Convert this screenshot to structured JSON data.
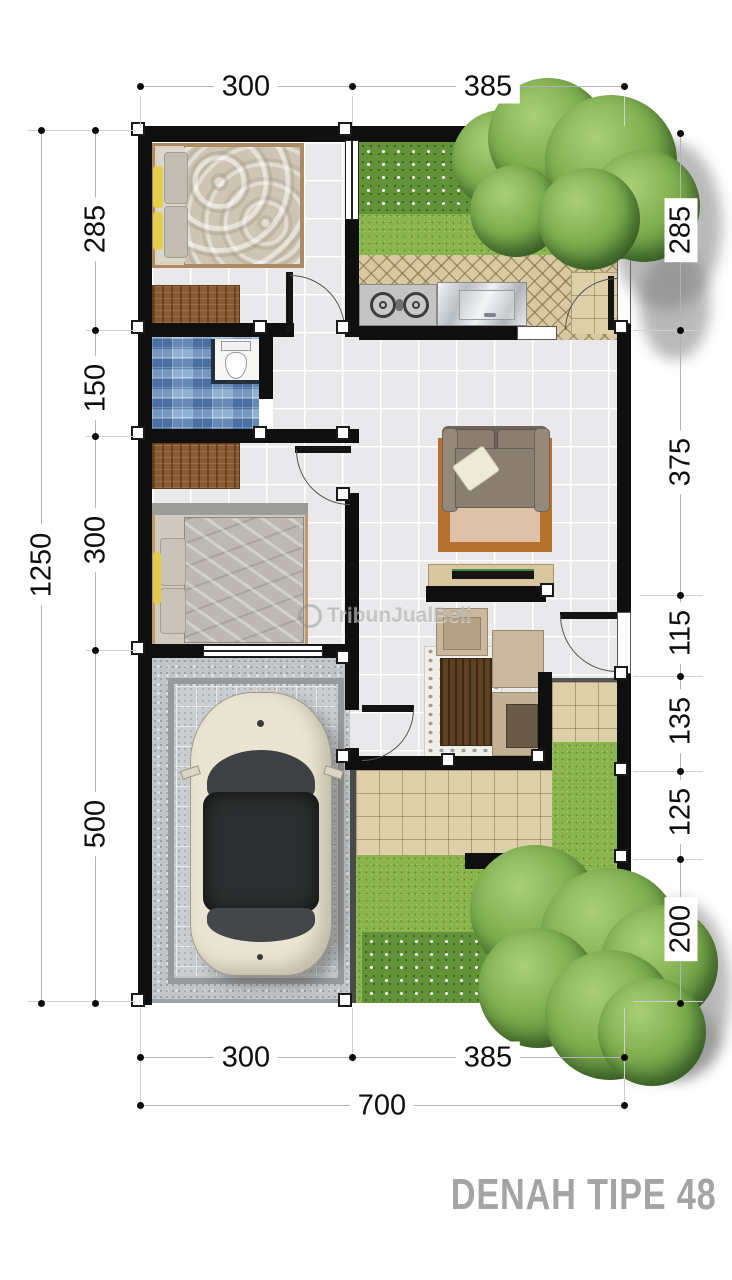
{
  "title": "DENAH TIPE 48",
  "watermark": "TribunJualBeli",
  "dims": {
    "top": [
      "300",
      "385"
    ],
    "left_overall": "1250",
    "left": [
      "285",
      "150",
      "300",
      "500"
    ],
    "right": [
      "285",
      "375",
      "115",
      "135",
      "125",
      "200"
    ],
    "bottom": [
      "300",
      "385"
    ],
    "bottom_overall": "700"
  },
  "colors": {
    "wall": "#0f0f0f",
    "floor_tile": "#e9e9ec",
    "kitchen_tile": "#d9c9a2",
    "bathroom_mosaic": "#7a9cc4",
    "terrace_tile": "#dccfa9",
    "grass": "#8ab54d",
    "garage_granite": "#c2c5c7",
    "dimension_text": "#0d0d0d",
    "title_text": "#a4a4a4"
  }
}
